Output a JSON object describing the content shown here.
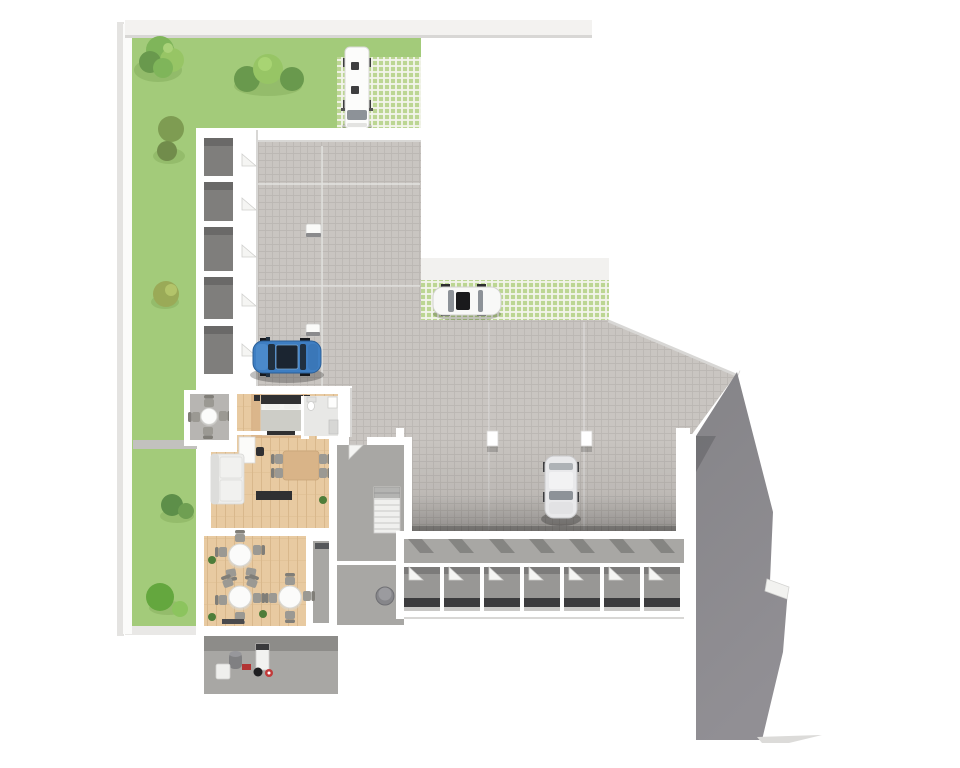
{
  "scene": {
    "kind": "3d-floor-plan-render",
    "floor": "ground-floor-with-apartment-garage-and-storage"
  },
  "colors": {
    "lawn": "#a3cb7a",
    "lawnShadow": "#82ab59",
    "gardenWall": "#c2c1be",
    "paverWhite": "#f3f4ec",
    "paverGreen": "#bcd693",
    "tile": "#c9c5c1",
    "tileLine": "#bbb7b3",
    "sidewalk": "#f2f1ef",
    "wall": "#ffffff",
    "wallShadow": "#d8d7d5",
    "ramp": "#8a898d",
    "concrete": "#a8a7a4",
    "concreteDark": "#8d8c89",
    "boxFloor": "#7f7e7c",
    "boxBack": "#6a6968",
    "unitFloor": "#989795",
    "unitBack": "#3b3b3d",
    "wood": "#e8caa1",
    "woodLine": "#d9b88c",
    "rug": "#d9b488",
    "bath": "#e8e8e6",
    "sofa": "#ededeb",
    "furnDark": "#303032",
    "kitchen": "#202022",
    "tableWood": "#d9b488",
    "chair": "#9b9993",
    "chairBack": "#807e78",
    "cafeTable": "#fbfbfa",
    "carBlue": "#3e7ec2",
    "carBlueDark": "#1b2531",
    "glass": "#8d9298",
    "carWhite": "#f8f8f7",
    "carSilver": "#e9e9eb",
    "vanWhite": "#fcfcfb",
    "treeDark": "#69994d",
    "treeMid": "#7fb55a",
    "treeLight": "#97c565",
    "bushOlive": "#7e9c52",
    "bushYellow": "#9aaa57",
    "bushBright": "#64a73e",
    "red": "#b23434",
    "plant": "#4e7d3a"
  },
  "inventory": {
    "vehicles": [
      {
        "name": "delivery-van",
        "color": "white",
        "parked_on": "grass-paver-pad-north"
      },
      {
        "name": "white-car",
        "color": "white",
        "parked_on": "grass-paver-strip-east"
      },
      {
        "name": "blue-car",
        "color": "blue",
        "parked_on": "courtyard-paving"
      },
      {
        "name": "silver-car",
        "color": "silver",
        "parked_on": "covered-parking-area"
      }
    ],
    "rooms": [
      {
        "name": "apartment",
        "features": [
          "bedroom",
          "bathroom",
          "living-dining",
          "kitchenette",
          "terrace"
        ]
      },
      {
        "name": "common-room",
        "round_tables": 3
      },
      {
        "name": "technical-room",
        "features": [
          "boiler-equipment"
        ]
      },
      {
        "name": "staircase-hall",
        "features": [
          "staircase",
          "tank-room"
        ]
      },
      {
        "name": "storage-compartments",
        "count": 7
      },
      {
        "name": "garage-boxes",
        "count": 5
      }
    ],
    "vegetation": {
      "trees": 1,
      "bushes": 10
    },
    "counts": {
      "storage_compartments": 7,
      "garage_boxes": 5,
      "cafe_tables": 3,
      "cafe_chairs": 14,
      "terrace_chairs": 4,
      "dining_chairs": 4,
      "parking_pillars": 2
    }
  }
}
